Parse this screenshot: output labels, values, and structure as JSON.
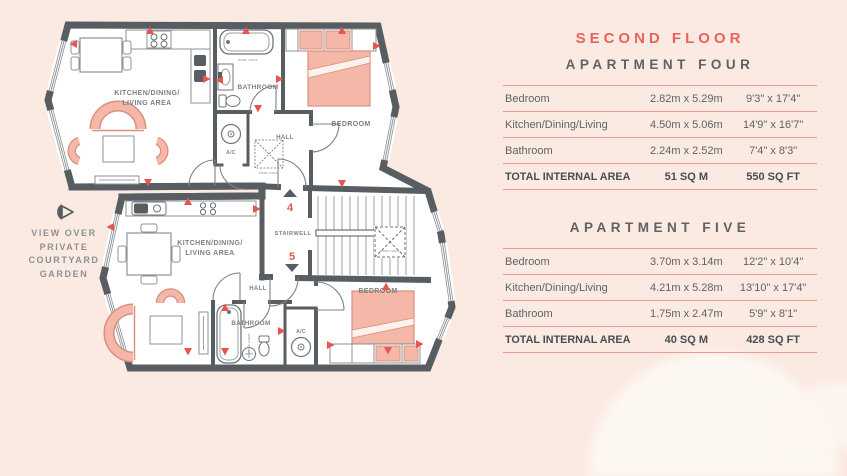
{
  "colors": {
    "background": "#fbeae2",
    "wall": "#585d62",
    "accent_red": "#e4574e",
    "title_coral": "#e8635b",
    "table_line": "#eb9c92",
    "text_gray": "#5d6266",
    "label_gray": "#7b8084",
    "furniture_salmon": "#f5b7a8"
  },
  "plan": {
    "view_note": "VIEW OVER PRIVATE COURTYARD GARDEN",
    "stairwell_label": "STAIRWELL",
    "roof_light": "ROOF LIGHT",
    "units": {
      "four": {
        "number": "4",
        "kitchen_line1": "KITCHEN/DINING/",
        "kitchen_line2": "LIVING AREA",
        "bathroom": "BATHROOM",
        "bedroom": "BEDROOM",
        "hall": "HALL",
        "ac": "A/C"
      },
      "five": {
        "number": "5",
        "kitchen_line1": "KITCHEN/DINING/",
        "kitchen_line2": "LIVING AREA",
        "bathroom": "BATHROOM",
        "bedroom": "BEDROOM",
        "hall": "HALL",
        "ac": "A/C"
      }
    }
  },
  "panel": {
    "floor_title": "SECOND FLOOR",
    "apartments": [
      {
        "name": "APARTMENT FOUR",
        "rows": [
          {
            "room": "Bedroom",
            "metric": "2.82m x 5.29m",
            "imperial": "9'3\" x 17'4\""
          },
          {
            "room": "Kitchen/Dining/Living",
            "metric": "4.50m x 5.06m",
            "imperial": "14'9\" x 16'7\""
          },
          {
            "room": "Bathroom",
            "metric": "2.24m x 2.52m",
            "imperial": "7'4\" x 8'3\""
          }
        ],
        "total": {
          "label": "TOTAL INTERNAL AREA",
          "metric": "51 SQ M",
          "imperial": "550 SQ FT"
        }
      },
      {
        "name": "APARTMENT FIVE",
        "rows": [
          {
            "room": "Bedroom",
            "metric": "3.70m x 3.14m",
            "imperial": "12'2\" x 10'4\""
          },
          {
            "room": "Kitchen/Dining/Living",
            "metric": "4.21m x 5.28m",
            "imperial": "13'10\" x 17'4\""
          },
          {
            "room": "Bathroom",
            "metric": "1.75m x 2.47m",
            "imperial": "5'9\" x 8'1\""
          }
        ],
        "total": {
          "label": "TOTAL INTERNAL AREA",
          "metric": "40 SQ M",
          "imperial": "428 SQ FT"
        }
      }
    ]
  }
}
